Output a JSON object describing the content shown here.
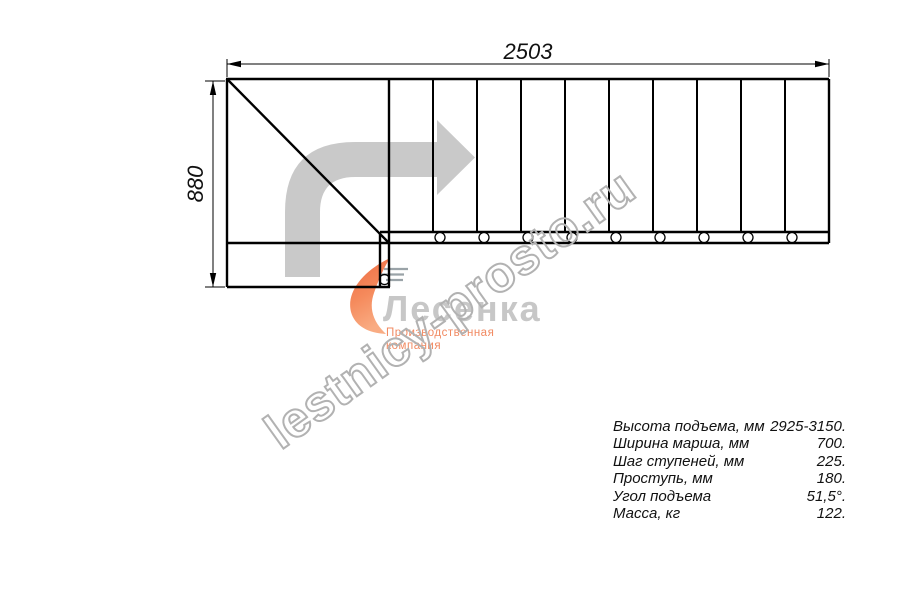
{
  "drawing": {
    "dimension_width_mm": "2503",
    "dimension_height_mm": "880"
  },
  "watermark": {
    "text": "lestnicy-prosto.ru"
  },
  "logo": {
    "name": "Лесенка",
    "tagline": "Производственная компания"
  },
  "specs": {
    "rows": [
      {
        "label": "Высота подъема, мм",
        "value": "2925-3150."
      },
      {
        "label": "Ширина марша, мм",
        "value": "700."
      },
      {
        "label": "Шаг ступеней, мм",
        "value": "225."
      },
      {
        "label": "Проступь, мм",
        "value": "180."
      },
      {
        "label": "Угол подъема",
        "value": "51,5°."
      },
      {
        "label": "Масса, кг",
        "value": "122."
      }
    ]
  },
  "colors": {
    "line": "#000000",
    "direction_arrow": "#c9c9c9",
    "watermark_outline": "#b2b2b2",
    "logo_gray": "#c7c7c7",
    "logo_orange": "#f07a4a"
  }
}
